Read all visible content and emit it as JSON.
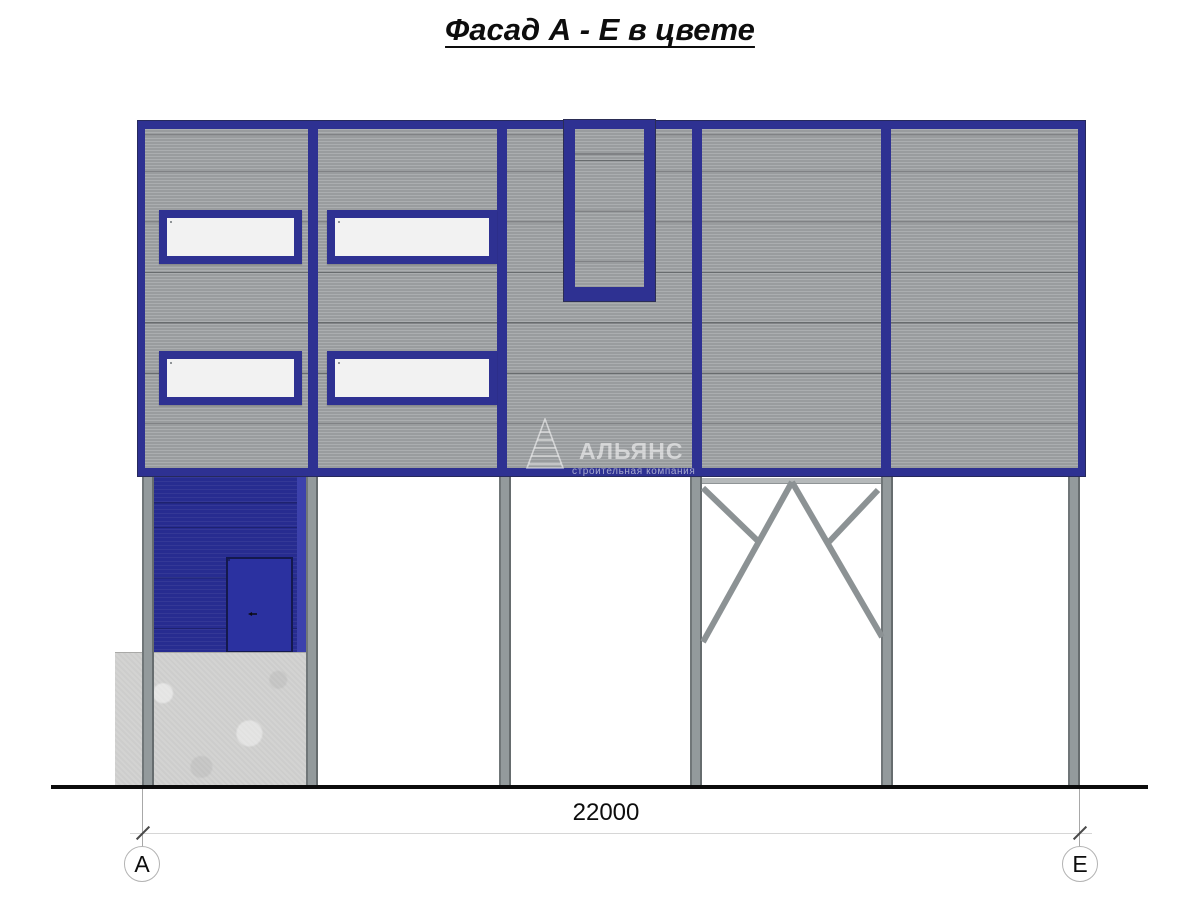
{
  "title": "Фасад А - Е в цвете",
  "watermark": {
    "company": "АЛЬЯНС",
    "tagline": "строительная компания"
  },
  "dimension": {
    "total_width": "22000"
  },
  "axis_markers": {
    "left": "А",
    "right": "Е"
  },
  "facade": {
    "bays": 5,
    "window_rows": 2,
    "window_count": 4,
    "panes_per_window": 4
  },
  "colors": {
    "trim_blue": "#2e3192",
    "siding_gray": "#9fa2a4",
    "entrance_blue": "#272c90",
    "door_blue": "#2b31a0",
    "glass_gray": "#d6d7d8",
    "column_gray": "#939a9c",
    "concrete_gray": "#d2d2d1",
    "ground_black": "#0c0c0c"
  }
}
